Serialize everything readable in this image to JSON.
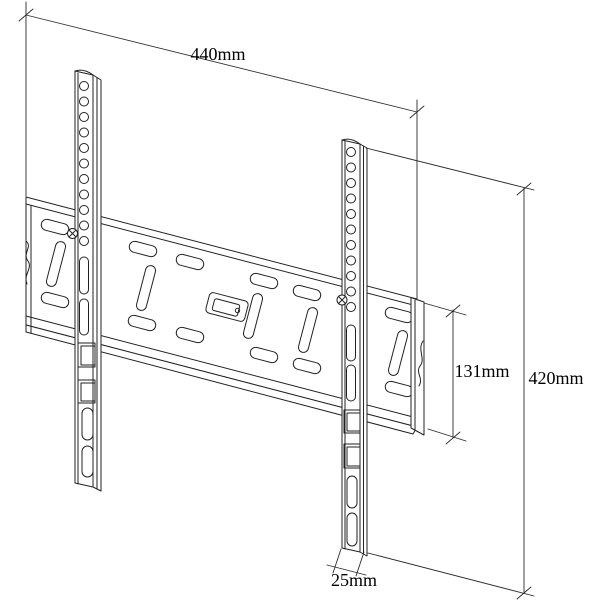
{
  "page": {
    "background": "#ffffff",
    "description": "Technical line drawing of a fixed flat TV wall-mount bracket (wall plate with two vertical VESA rails) shown in perspective with dimension callouts"
  },
  "drawing": {
    "line_color": "#222222",
    "unit": "mm",
    "labels": {
      "width": "440mm",
      "height": "420mm",
      "plate_height": "131mm",
      "rail_width": "25mm"
    },
    "values": {
      "width_mm": 440,
      "height_mm": 420,
      "plate_height_mm": 131,
      "rail_width_mm": 25
    }
  }
}
